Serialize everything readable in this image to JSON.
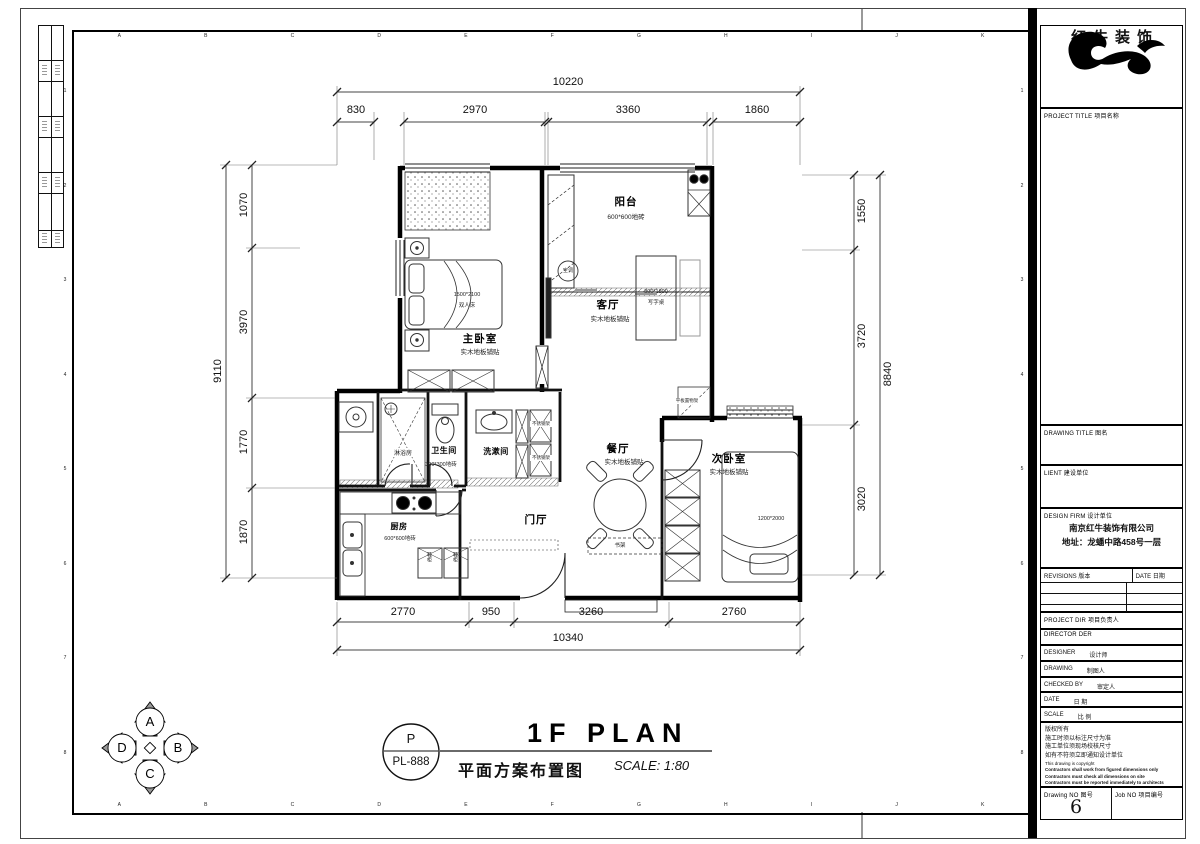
{
  "sheet": {
    "grid_letters": [
      "A",
      "B",
      "C",
      "D",
      "E",
      "F",
      "G",
      "H",
      "I",
      "J",
      "K"
    ],
    "grid_numbers": [
      "1",
      "2",
      "3",
      "4",
      "5",
      "6",
      "7",
      "8"
    ]
  },
  "brand": {
    "logo_text": "红牛装饰"
  },
  "title_block": {
    "project_title": "PROJECT TITLE  项目名称",
    "drawing_title": "DRAWING TITLE  图名",
    "client": "LIENT  建设单位",
    "design_firm": "DESIGN FIRM  设计单位",
    "firm_name": "南京红牛装饰有限公司",
    "firm_address": "地址：龙蟠中路458号一层",
    "revisions": "REVISIONS  版本",
    "rev_date": "DATE  日期",
    "project_dir": "PROJECT DIR  项目负责人",
    "director": "DIRECTOR DER",
    "designer": "DESIGNER",
    "designer_cn": "设计师",
    "drawing": "DRAWING",
    "drawing_cn": "制图人",
    "checked_by": "CHECKED BY",
    "checked_cn": "审定人",
    "date": "DATE",
    "date_cn": "日  期",
    "scale": "SCALE",
    "scale_cn": "比  例",
    "copyright_lines": [
      "版权所有",
      "施工时须以标注尺寸为准",
      "施工单位须现场校核尺寸",
      "如有不符须立即通知设计单位",
      "This drawing is copyright",
      "Contractors shall work from figured dimensions only",
      "Contractors must check all dimensions on site",
      "Contractors must be reported immediately to architects"
    ],
    "drawing_no_label": "Drawing NO  图号",
    "drawing_no": "6",
    "job_no_label": "Job NO  项目编号"
  },
  "plan": {
    "rooms": {
      "master_bedroom": {
        "name": "主卧室",
        "finish": "实木地板铺贴"
      },
      "balcony": {
        "name": "阳台",
        "finish": "600*600地砖"
      },
      "living_room": {
        "name": "客厅",
        "finish": "实木地板铺贴"
      },
      "shower_room": {
        "name": "淋浴房"
      },
      "bathroom": {
        "name": "卫生间",
        "finish": "300*300地砖"
      },
      "washroom": {
        "name": "洗漱间"
      },
      "kitchen": {
        "name": "厨房",
        "finish": "600*600地砖"
      },
      "foyer": {
        "name": "门厅"
      },
      "dining_room": {
        "name": "餐厅",
        "finish": "实木地板铺贴"
      },
      "second_bedroom": {
        "name": "次卧室",
        "finish": "实木地板铺贴"
      }
    },
    "furniture": {
      "double_bed_size": "1500*2100",
      "double_bed": "双人床",
      "desk_size": "800*1800",
      "desk": "写字桌",
      "single_bed_size": "1200*2000",
      "ac": "空调",
      "shelf": "平板置物架",
      "bookshelf": "书架",
      "steel_rack": "不锈钢架",
      "shoe_cabinet": "鞋柜"
    },
    "dims": {
      "top": {
        "overall": "10220",
        "segments": [
          "830",
          "2970",
          "3360",
          "1860"
        ]
      },
      "left": {
        "overall": "9110",
        "segments": [
          "1070",
          "3970",
          "1770",
          "1870"
        ]
      },
      "right": {
        "overall": "8840",
        "segments": [
          "1550",
          "3720",
          "3020"
        ]
      },
      "bottom": {
        "overall": "10340",
        "segments": [
          "2770",
          "950",
          "3260",
          "2760"
        ]
      }
    }
  },
  "footer": {
    "stamp_letter": "P",
    "stamp_code": "PL-888",
    "title_en": "1F PLAN",
    "title_cn": "平面方案布置图",
    "scale_text": "SCALE: 1:80"
  },
  "compass": {
    "a": "A",
    "b": "B",
    "c": "C",
    "d": "D"
  }
}
